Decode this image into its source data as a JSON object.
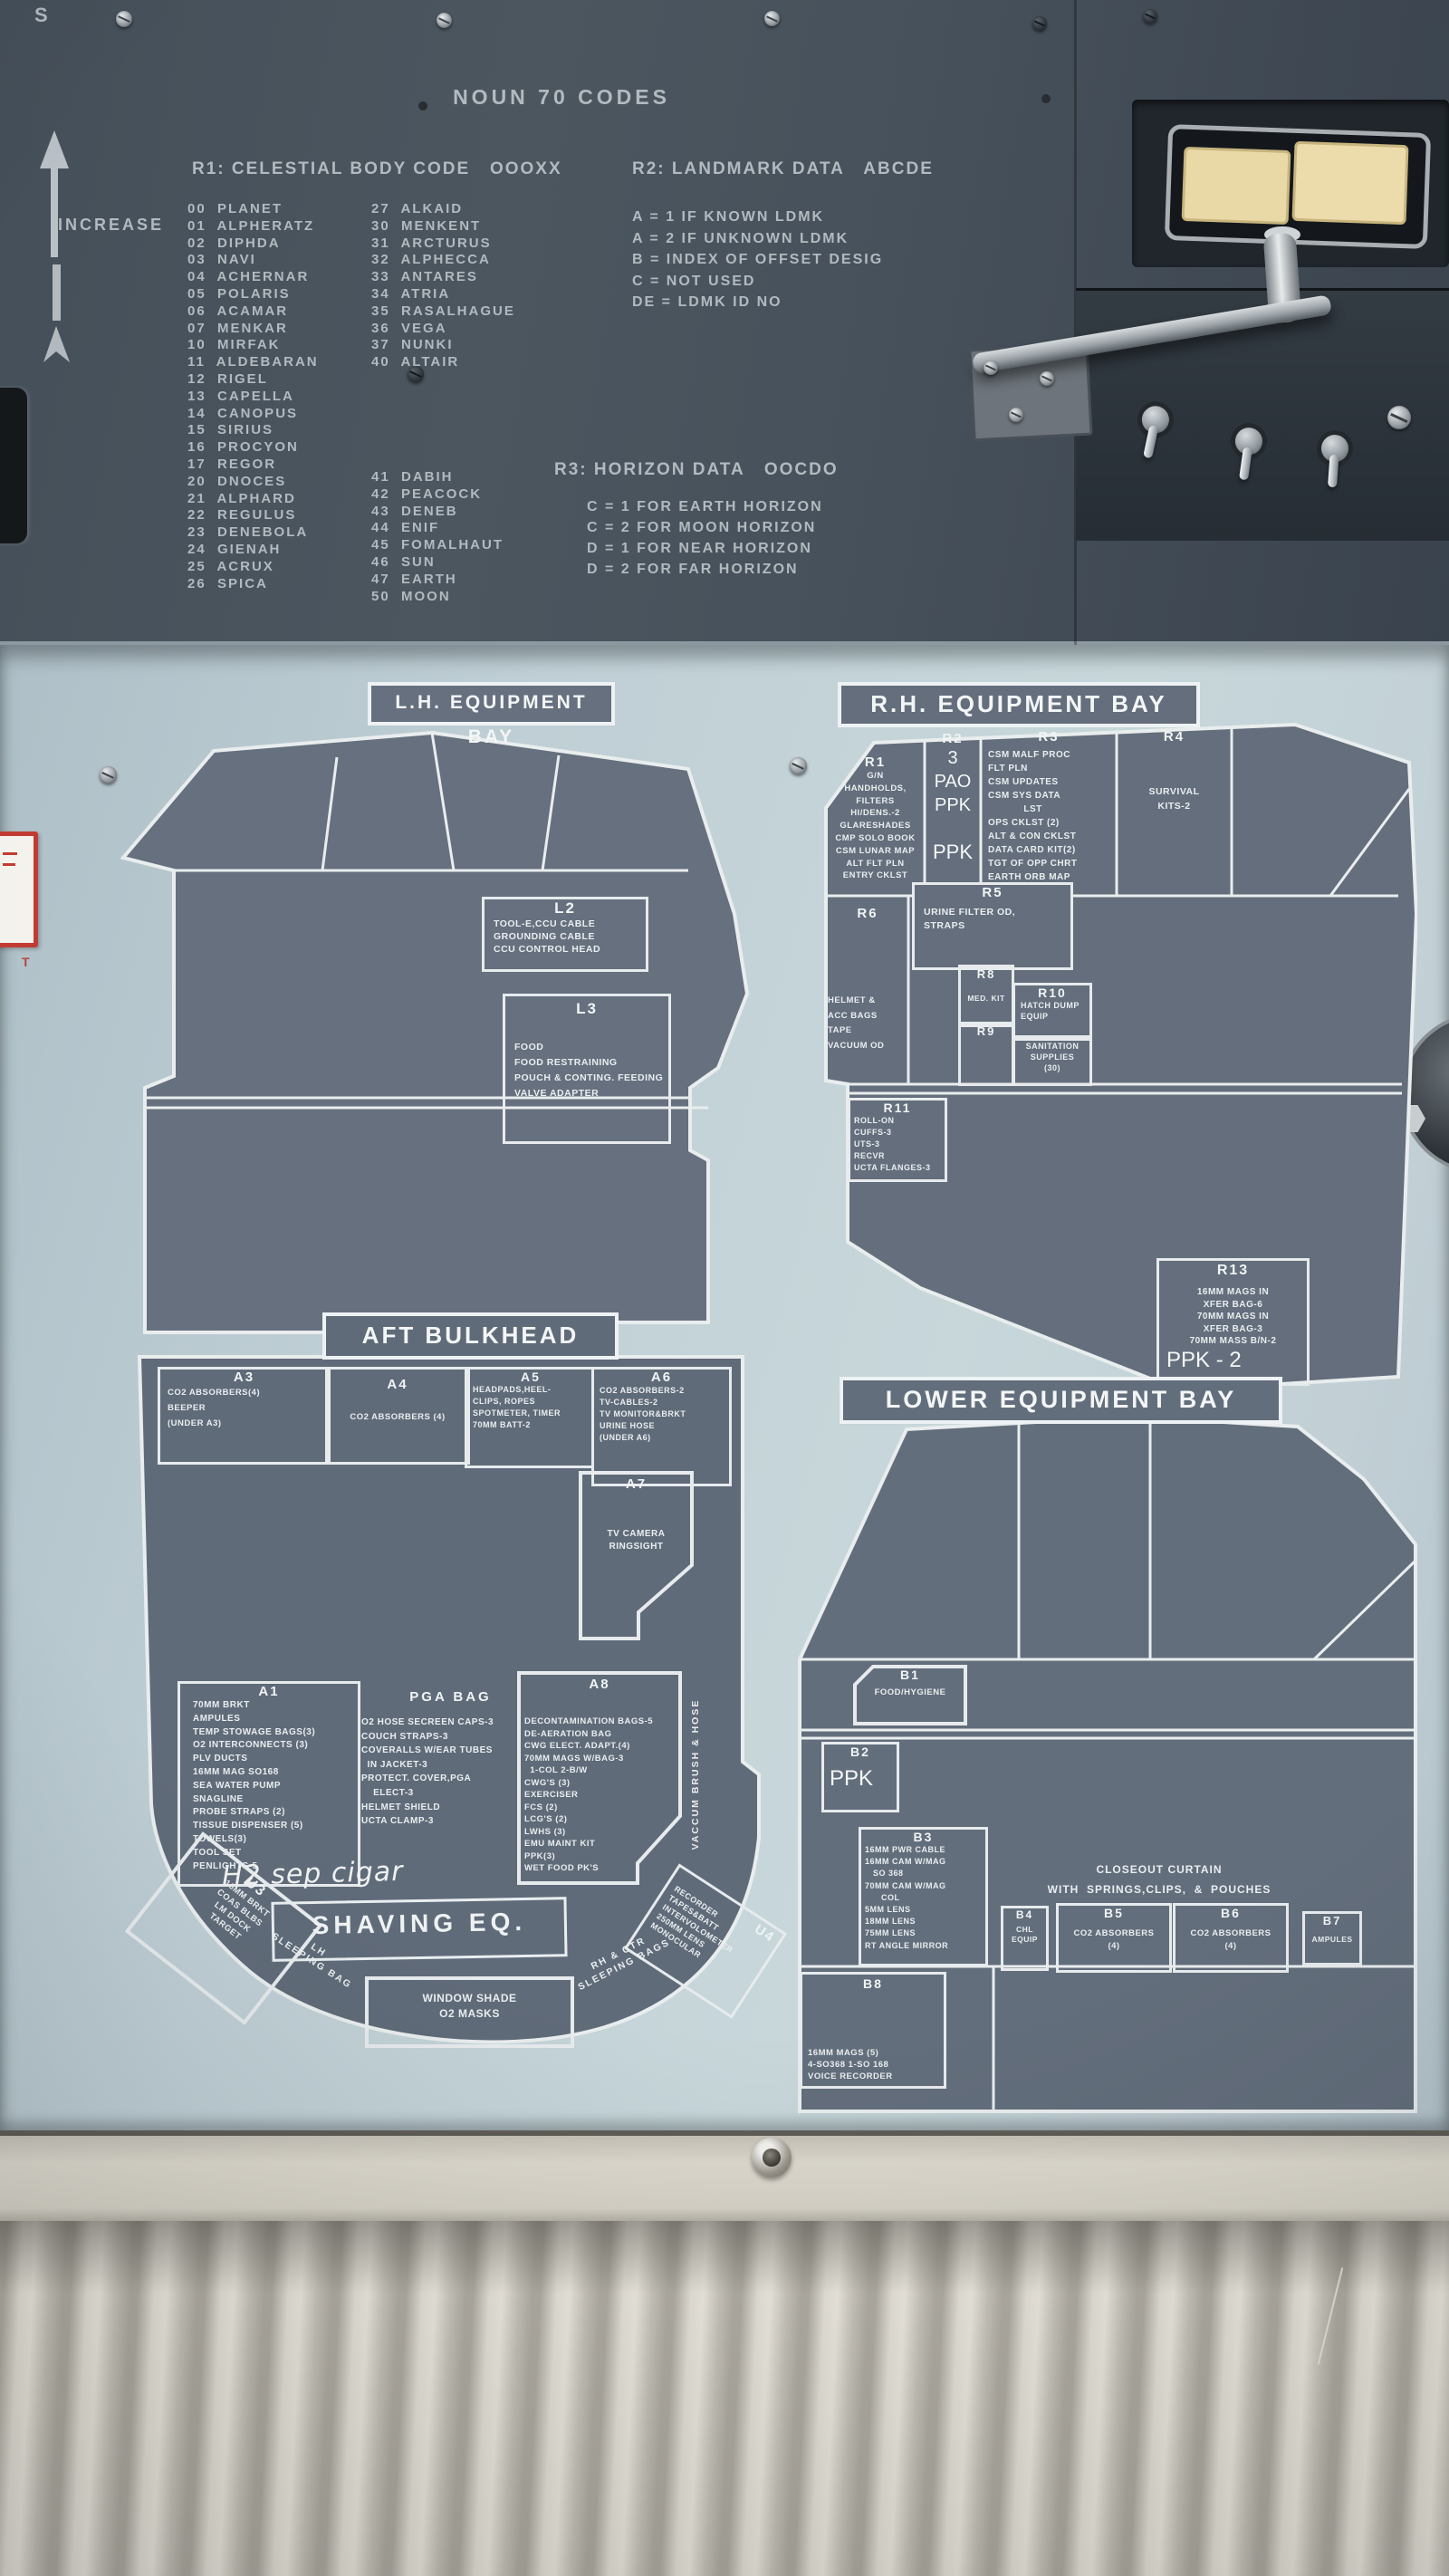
{
  "colors": {
    "top_panel": "#4c565f",
    "mid_panel": "#c2d2d7",
    "placard": "#646e7c",
    "placard_line": "#e9edee",
    "lamp_cream": "#e9d9a6",
    "curtain": "#dad6cc",
    "red_tag": "#c23b32"
  },
  "top_panel": {
    "partial_label": "S",
    "increase_label": "INCREASE",
    "title": "NOUN 70 CODES",
    "r1_header": "R1: CELESTIAL BODY CODE   OOOXX",
    "r2_header": "R2: LANDMARK DATA   ABCDE",
    "codes_col1": [
      "00  PLANET",
      "01  ALPHERATZ",
      "02  DIPHDA",
      "03  NAVI",
      "04  ACHERNAR",
      "05  POLARIS",
      "06  ACAMAR",
      "07  MENKAR",
      "10  MIRFAK",
      "11  ALDEBARAN",
      "12  RIGEL",
      "13  CAPELLA",
      "14  CANOPUS",
      "15  SIRIUS",
      "16  PROCYON",
      "17  REGOR",
      "20  DNOCES",
      "21  ALPHARD",
      "22  REGULUS",
      "23  DENEBOLA",
      "24  GIENAH",
      "25  ACRUX",
      "26  SPICA"
    ],
    "codes_col2a": [
      "27  ALKAID",
      "30  MENKENT",
      "31  ARCTURUS",
      "32  ALPHECCA",
      "33  ANTARES",
      "34  ATRIA",
      "35  RASALHAGUE",
      "36  VEGA",
      "37  NUNKI",
      "40  ALTAIR"
    ],
    "codes_col2b": [
      "41  DABIH",
      "42  PEACOCK",
      "43  DENEB",
      "44  ENIF",
      "45  FOMALHAUT",
      "46  SUN",
      "47  EARTH",
      "50  MOON"
    ],
    "r2_lines": [
      "A = 1 IF KNOWN LDMK",
      "A = 2 IF UNKNOWN LDMK",
      "B = INDEX OF OFFSET DESIG",
      "C = NOT USED",
      "DE = LDMK ID NO"
    ],
    "r3_header": "R3: HORIZON DATA   OOCDO",
    "r3_lines": [
      "C = 1 FOR EARTH HORIZON",
      "C = 2 FOR MOON HORIZON",
      "D = 1 FOR NEAR HORIZON",
      "D = 2 FOR FAR HORIZON"
    ]
  },
  "lh_bay": {
    "title": "L.H. EQUIPMENT BAY",
    "l2": {
      "title": "L2",
      "lines": [
        "TOOL-E,CCU CABLE",
        "GROUNDING CABLE",
        "CCU CONTROL HEAD"
      ]
    },
    "l3": {
      "title": "L3",
      "lines": [
        "FOOD",
        "FOOD RESTRAINING",
        "POUCH & CONTING. FEEDING",
        "VALVE ADAPTER"
      ]
    }
  },
  "rh_bay": {
    "title": "R.H. EQUIPMENT BAY",
    "r1": {
      "title": "R1",
      "lines": [
        "G/N",
        "HANDHOLDS,",
        "FILTERS",
        "HI/DENS.-2",
        "GLARESHADES",
        "CMP SOLO BOOK",
        "CSM LUNAR MAP",
        "ALT FLT PLN",
        "ENTRY CKLST"
      ]
    },
    "r2": {
      "title": "R2",
      "marks": [
        "3",
        "PAO",
        "PPK"
      ],
      "mark2": "PPK"
    },
    "r3": {
      "title": "R3",
      "lines": [
        "CSM MALF PROC",
        "FLT PLN",
        "CSM UPDATES",
        "CSM SYS DATA",
        "            LST",
        "OPS CKLST (2)",
        "ALT & CON CKLST",
        "DATA CARD KIT(2)",
        "TGT OF OPP CHRT",
        "EARTH ORB MAP"
      ]
    },
    "r4": {
      "title": "R4",
      "lines": [
        "SURVIVAL",
        "KITS-2"
      ]
    },
    "r5": {
      "title": "R5",
      "lines": [
        "URINE FILTER OD,",
        "STRAPS"
      ]
    },
    "r6": {
      "title": "R6",
      "lines": [
        "HELMET &",
        "ACC BAGS",
        "TAPE",
        "VACUUM OD"
      ]
    },
    "r8": {
      "title": "R8",
      "lines": [
        "MED. KIT"
      ]
    },
    "r9": {
      "title": "R9"
    },
    "r10": {
      "title": "R10",
      "lines": [
        "HATCH DUMP",
        "EQUIP"
      ]
    },
    "sanitation": {
      "lines": [
        "SANITATION",
        "SUPPLIES",
        "(30)"
      ]
    },
    "r11": {
      "title": "R11",
      "lines": [
        "ROLL-ON",
        "CUFFS-3",
        "UTS-3",
        "RECVR",
        "UCTA FLANGES-3"
      ]
    },
    "r13": {
      "title": "R13",
      "lines": [
        "16MM MAGS IN",
        "XFER BAG-6",
        "70MM MAGS IN",
        "XFER BAG-3",
        "70MM MASS B/N-2"
      ],
      "ppk": "PPK - 2"
    }
  },
  "aft_bulkhead": {
    "title": "AFT BULKHEAD",
    "a3": {
      "title": "A3",
      "lines": [
        "CO2 ABSORBERS(4)",
        "BEEPER",
        "(UNDER A3)"
      ]
    },
    "a4": {
      "title": "A4",
      "lines": [
        "CO2 ABSORBERS (4)"
      ]
    },
    "a5": {
      "title": "A5",
      "lines": [
        "HEADPADS,HEEL-",
        "CLIPS, ROPES",
        "SPOTMETER, TIMER",
        "70MM BATT-2"
      ]
    },
    "a6": {
      "title": "A6",
      "lines": [
        "CO2 ABSORBERS-2",
        "TV-CABLES-2",
        "TV MONITOR&BRKT",
        "URINE HOSE",
        "(UNDER A6)"
      ]
    },
    "a7": {
      "title": "A7",
      "lines": [
        "TV CAMERA",
        "RINGSIGHT"
      ]
    },
    "a1": {
      "title": "A1",
      "lines": [
        "70MM BRKT",
        "AMPULES",
        "TEMP STOWAGE BAGS(3)",
        "O2 INTERCONNECTS (3)",
        "PLV DUCTS",
        "16MM MAG SO168",
        "SEA WATER PUMP",
        "SNAGLINE",
        "PROBE STRAPS (2)",
        "TISSUE DISPENSER (5)",
        "TOWELS(3)",
        "TOOL SET",
        "PENLIGHTS-5"
      ]
    },
    "pga": {
      "title": "PGA BAG",
      "lines": [
        "O2 HOSE SECREEN CAPS-3",
        "COUCH STRAPS-3",
        "COVERALLS W/EAR TUBES",
        "  IN JACKET-3",
        "PROTECT. COVER,PGA",
        "    ELECT-3",
        "HELMET SHIELD",
        "UCTA CLAMP-3"
      ]
    },
    "a8": {
      "title": "A8",
      "lines": [
        "DECONTAMINATION BAGS-5",
        "DE-AERATION BAG",
        "CWG ELECT. ADAPT.(4)",
        "70MM MAGS W/BAG-3",
        "  1-COL 2-B/W",
        "CWG'S (3)",
        "EXERCISER",
        "FCS (2)",
        "LCG'S (2)",
        "LWHS (3)",
        "EMU MAINT KIT",
        "PPK(3)",
        "WET FOOD PK'S"
      ]
    },
    "vacuum_label": "VACCUM BRUSH & HOSE",
    "u3": {
      "title": "U3",
      "lines": [
        "16MM BRKT",
        "COAS BLBS",
        "LM DOCK",
        "TARGET"
      ]
    },
    "handwriting": "H2 sep cigar",
    "shaving": "SHAVING EQ.",
    "u4": {
      "title": "U4",
      "lines": [
        "RECORDER",
        "TAPES&BATT",
        "INTERVOLOMETER",
        "250MM LENS",
        "MONOCULAR"
      ]
    },
    "lh_sleeping": [
      "LH",
      "SLEEPING BAG"
    ],
    "window_shade": [
      "WINDOW SHADE",
      "O2 MASKS"
    ],
    "rh_sleeping": [
      "RH & CTR",
      "SLEEPING BAGS"
    ]
  },
  "lower_bay": {
    "title": "LOWER EQUIPMENT BAY",
    "b1": {
      "title": "B1",
      "lines": [
        "FOOD/HYGIENE"
      ]
    },
    "b2": {
      "title": "B2",
      "mark": "PPK"
    },
    "b3": {
      "title": "B3",
      "lines": [
        "16MM PWR CABLE",
        "16MM CAM W/MAG",
        "   SO 368",
        "70MM CAM W/MAG",
        "      COL",
        "5MM LENS",
        "18MM LENS",
        "75MM LENS",
        "RT ANGLE MIRROR"
      ]
    },
    "closeout": [
      "CLOSEOUT CURTAIN",
      "WITH  SPRINGS,CLIPS,  &  POUCHES"
    ],
    "b4": {
      "title": "B4",
      "lines": [
        "CHL",
        "EQUIP"
      ]
    },
    "b5": {
      "title": "B5",
      "lines": [
        "CO2 ABSORBERS",
        "(4)"
      ]
    },
    "b6": {
      "title": "B6",
      "lines": [
        "CO2 ABSORBERS",
        "(4)"
      ]
    },
    "b7": {
      "title": "B7",
      "lines": [
        "AMPULES"
      ]
    },
    "b8": {
      "title": "B8",
      "lines": [
        "16MM MAGS (5)",
        "4-SO368 1-SO 168",
        "VOICE RECORDER"
      ]
    }
  }
}
